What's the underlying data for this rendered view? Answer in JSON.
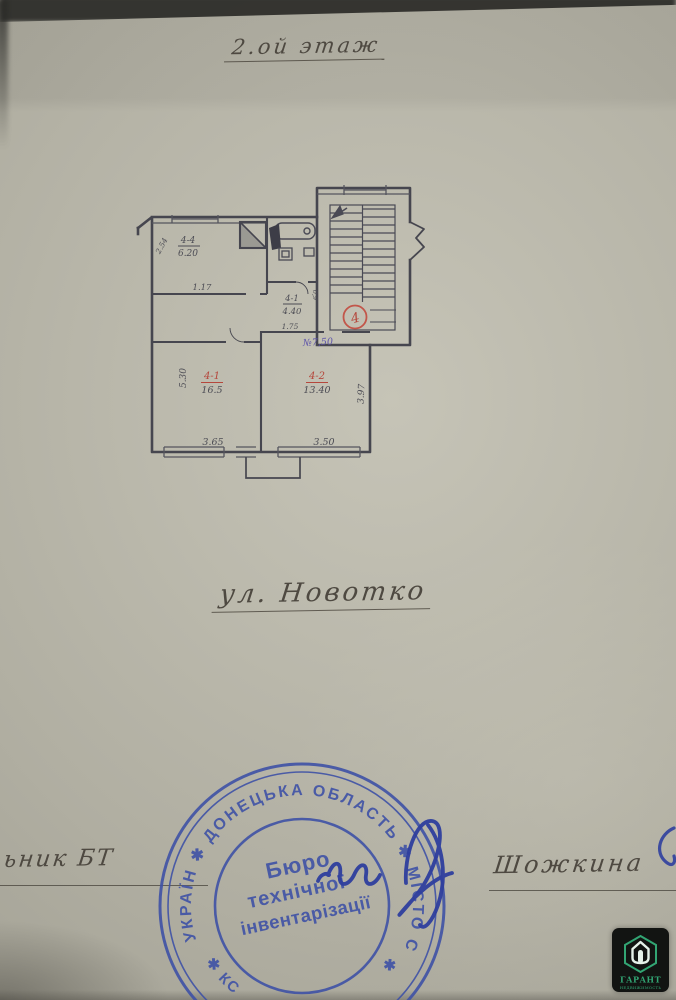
{
  "page": {
    "floor_title": "2.ой этаж",
    "street_label": "ул. Новотко"
  },
  "plan": {
    "apartment_circle": "4",
    "purple_note": "№7,50",
    "rooms": {
      "kitchen": {
        "id": "4-4",
        "area": "6.20"
      },
      "hall": {
        "id": "4-1",
        "area": "4.40"
      },
      "room1": {
        "id": "4-1",
        "area": "16.5"
      },
      "room2": {
        "id": "4-2",
        "area": "13.40"
      }
    },
    "dims": {
      "kitchen_diag": "2.54",
      "kitchen_width": "1.17",
      "hall_width": "1.75",
      "hall_side": "0,9",
      "left_height": "5.30",
      "bottom_left": "3.65",
      "bottom_right": "3.50",
      "right_height": "3.97"
    }
  },
  "signatures": {
    "left_label": "ьник БТ",
    "right_name": "Шожкина"
  },
  "stamp": {
    "arc_top": "УКРАЇН ✱ ДОНЕЦЬКА ОБЛАСТЬ ✱ МІСТО СНІЖНЕ",
    "arc_bottom_left": "✱  КС",
    "arc_bottom_right": "✱",
    "line1": "Бюро",
    "line2": "технічної",
    "line3": "інвентарізації",
    "ink_color": "#3f52a6"
  },
  "watermark": {
    "brand": "ГАРАНТ",
    "sub": "НЕДВИЖИМОСТЬ",
    "accent": "#2da572"
  }
}
